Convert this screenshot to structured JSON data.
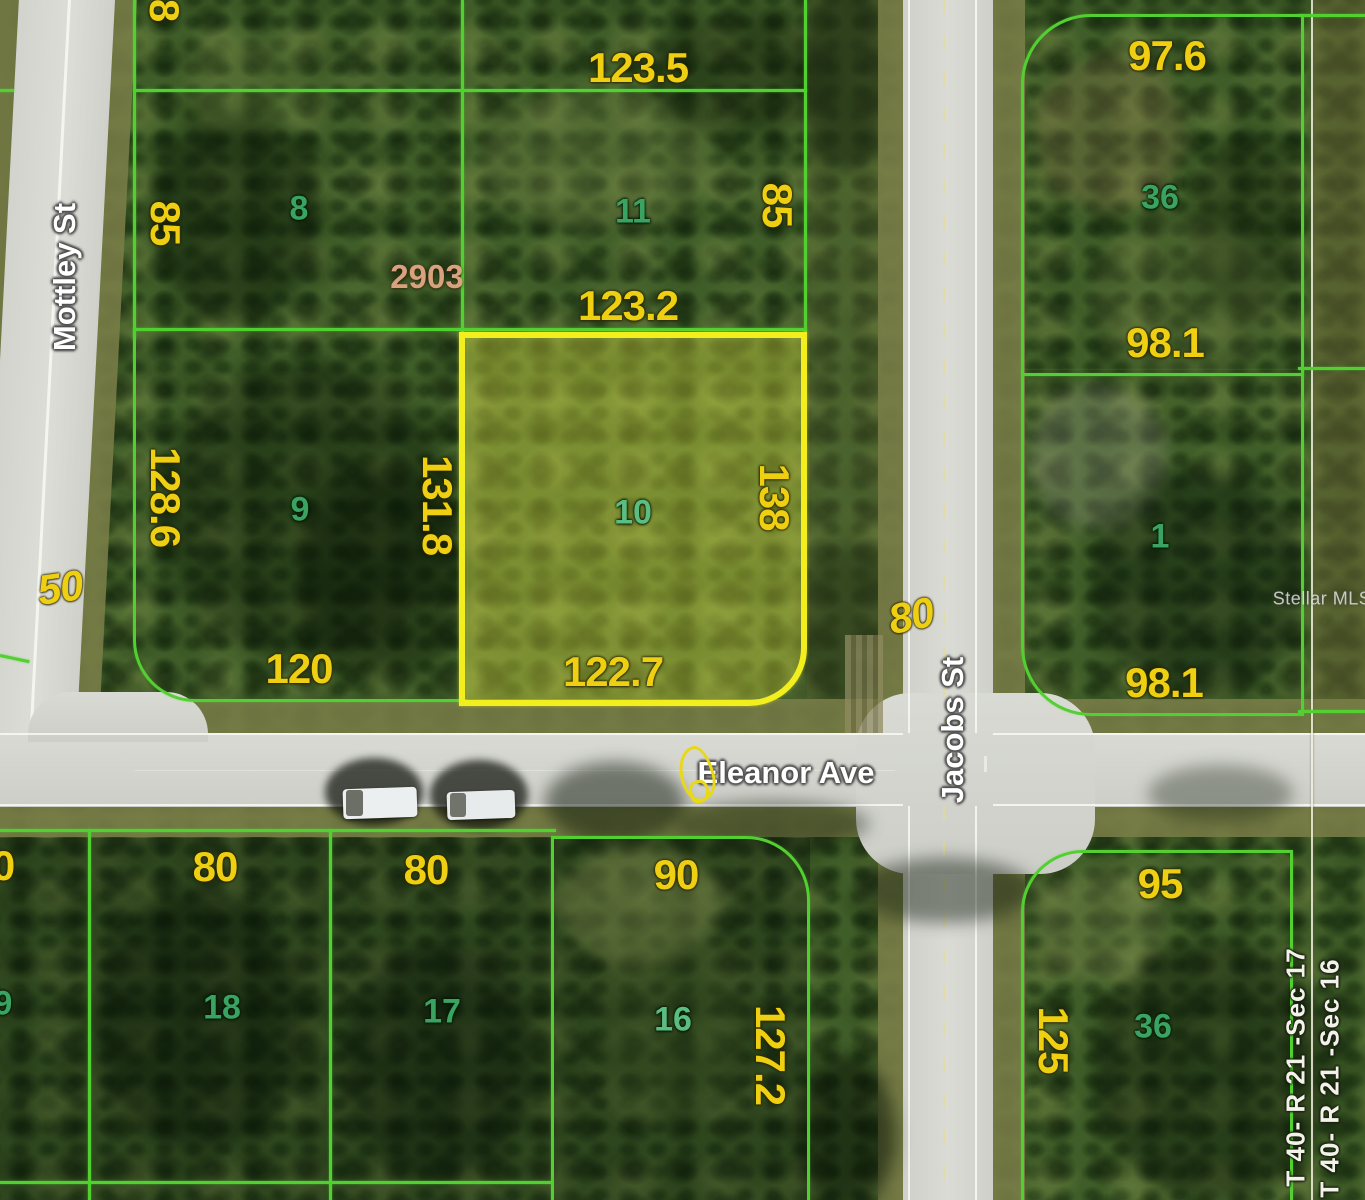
{
  "map": {
    "type": "parcel-satellite-map",
    "watermark": "Stellar MLS",
    "streets": {
      "vertical_left": "Mottley St",
      "horizontal": "Eleanor Ave",
      "vertical_right": "Jacobs St"
    },
    "section_labels": {
      "west": "T 40- R 21 -Sec 17",
      "east": "T 40- R 21 -Sec 16"
    },
    "top_edge_dim": "8",
    "road_dims": {
      "mottley": "50",
      "jacobs": "80"
    },
    "highlighted_parcel": {
      "number": "10",
      "dim_top": "123.2",
      "dim_left": "131.8",
      "dim_right": "138",
      "dim_bottom": "122.7"
    },
    "parcels": {
      "p8": {
        "number": "8",
        "dim_left": "85",
        "address": "2903"
      },
      "p11": {
        "number": "11",
        "dim_top": "123.5",
        "dim_right": "85"
      },
      "p9": {
        "number": "9",
        "dim_left": "128.6",
        "dim_bottom": "120"
      },
      "p36_north": {
        "number": "36",
        "dim_top": "97.6",
        "dim_bottom": "98.1"
      },
      "p1": {
        "number": "1",
        "dim_bottom": "98.1"
      },
      "p18": {
        "number": "18",
        "dim_top": "80"
      },
      "p17": {
        "number": "17",
        "dim_top": "80"
      },
      "p16": {
        "number": "16",
        "dim_top": "90",
        "dim_right": "127.2"
      },
      "p36_south": {
        "number": "36",
        "dim_top": "95",
        "dim_left": "125"
      },
      "edge_partial": {
        "dim": "0",
        "number": "9"
      }
    },
    "colors": {
      "parcel_line": "#53cf31",
      "highlight_border": "#f3ef1e",
      "highlight_fill": "rgba(235,235,70,0.35)",
      "dimension_text": "#efcf12",
      "parcel_number_text": "#3aa362",
      "address_text": "#d9a27e",
      "street_text": "#ffffff",
      "section_text": "#f2f2ea",
      "pavement": "#d4d5cf",
      "shoulder": "#7a7d48"
    }
  }
}
